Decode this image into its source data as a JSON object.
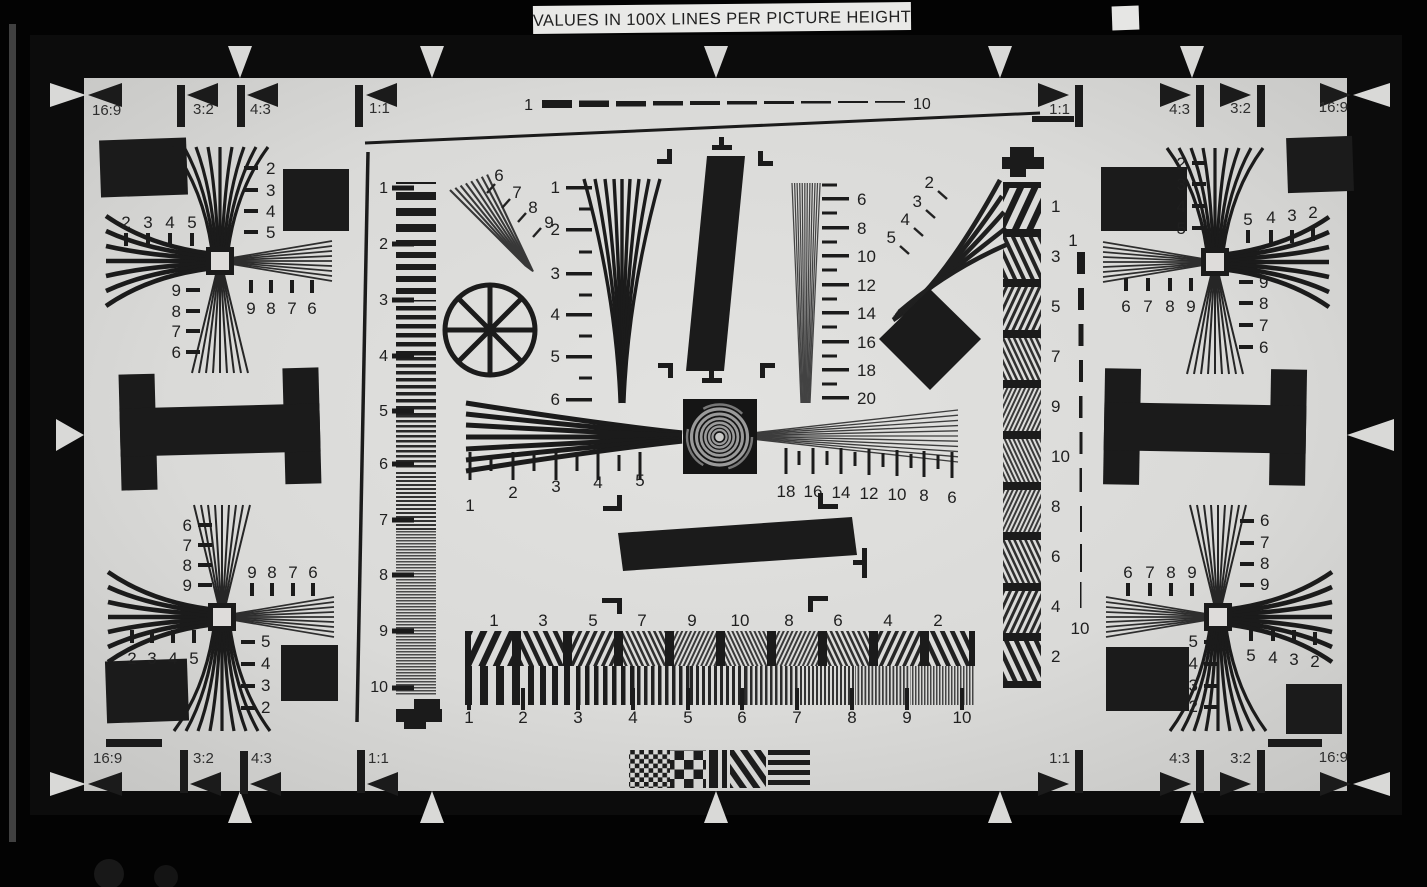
{
  "banner": {
    "text": "VALUES IN 100X LINES PER PICTURE HEIGHT"
  },
  "colors": {
    "ink": "#1b1b1b",
    "paper": "#dcdcda",
    "background": "#020202"
  },
  "aspect_labels": {
    "top_left": [
      "16:9",
      "3:2",
      "4:3",
      "1:1"
    ],
    "top_right": [
      "1:1",
      "4:3",
      "3:2",
      "16:9"
    ],
    "bottom_left": [
      "16:9",
      "3:2",
      "4:3",
      "1:1"
    ],
    "bottom_right": [
      "1:1",
      "4:3",
      "3:2",
      "16:9"
    ]
  },
  "scales": {
    "top_dashed": [
      "1",
      "10"
    ],
    "left_ruler": [
      "1",
      "2",
      "3",
      "4",
      "5",
      "6",
      "7",
      "8",
      "9",
      "10"
    ],
    "center_left_wedge": [
      "1",
      "2",
      "3",
      "4",
      "5",
      "6"
    ],
    "center_right_wedge": [
      "6",
      "8",
      "10",
      "12",
      "14",
      "16",
      "18",
      "20"
    ],
    "diagonal_left": [
      "6",
      "7",
      "8",
      "9"
    ],
    "diagonal_right": [
      "2",
      "3",
      "4",
      "5"
    ],
    "horizontal_left": [
      "1",
      "2",
      "3",
      "4",
      "5"
    ],
    "horizontal_right": [
      "18",
      "16",
      "14",
      "12",
      "10",
      "8",
      "6"
    ],
    "bottom_upper_row": [
      "1",
      "3",
      "5",
      "7",
      "9",
      "10",
      "8",
      "6",
      "4",
      "2"
    ],
    "bottom_lower_row": [
      "1",
      "2",
      "3",
      "4",
      "5",
      "6",
      "7",
      "8",
      "9",
      "10"
    ],
    "right_strip": [
      "1",
      "3",
      "5",
      "7",
      "9",
      "10",
      "8",
      "6",
      "4",
      "2"
    ],
    "right_dashed": [
      "1",
      "10"
    ]
  },
  "clusters": {
    "upper_left": {
      "top": [
        "2",
        "3",
        "4",
        "5"
      ],
      "left": [
        "2",
        "3",
        "4",
        "5"
      ],
      "bottom_left": [
        "9",
        "8",
        "7",
        "6"
      ],
      "bottom_right": [
        "9",
        "8",
        "7",
        "6"
      ]
    },
    "upper_right": {
      "top": [
        "2",
        "3",
        "4",
        "5"
      ],
      "right": [
        "5",
        "4",
        "3",
        "2"
      ],
      "bottom_left": [
        "6",
        "7",
        "8",
        "9"
      ],
      "bottom_right": [
        "9",
        "8",
        "7",
        "6"
      ]
    },
    "lower_left": {
      "top_left": [
        "6",
        "7",
        "8",
        "9"
      ],
      "top_right": [
        "9",
        "8",
        "7",
        "6"
      ],
      "bottom_left": [
        "2",
        "3",
        "4",
        "5"
      ],
      "bottom_right": [
        "5",
        "4",
        "3",
        "2"
      ]
    },
    "lower_right": {
      "top_left": [
        "6",
        "7",
        "8",
        "9"
      ],
      "top_right": [
        "6",
        "7",
        "8",
        "9"
      ],
      "bottom_left": [
        "5",
        "4",
        "3",
        "2"
      ],
      "bottom_right": [
        "5",
        "4",
        "3",
        "2"
      ]
    }
  }
}
